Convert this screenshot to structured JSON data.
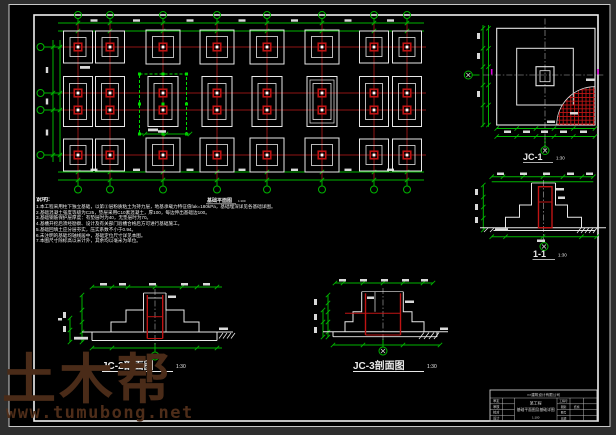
{
  "colors": {
    "window_bg": "#2e2e2e",
    "sheet": "#000000",
    "frame": "#d8d8d8",
    "green": "#00b400",
    "sel_green": "#00dd00",
    "axis_red": "#8f1414",
    "red": "#c01414",
    "white": "#e8e8e8",
    "magenta": "#dd00dd",
    "watermark": "#4a2b18"
  },
  "plan": {
    "title": "基础平面图",
    "scale": "1:100",
    "column_axes": [
      78,
      110,
      163,
      217,
      267,
      322,
      374,
      407
    ],
    "row_axes": [
      47,
      93,
      110,
      155
    ],
    "pair_columns": [
      0,
      1,
      6,
      7
    ],
    "selected_column_index": 2,
    "double_outline_column_index": 5
  },
  "notes": {
    "heading": "说明:",
    "lines": [
      "1.本工程采用柱下独立基础，以第②层粉质粘土为持力层，地基承载力特征值fak=180kPa，基础埋深详见各基础详图。",
      "2.基础混凝土强度等级为C25，垫层采用C10素混凝土，厚100，每边伸出基础边100。",
      "3.基础钢筋保护层厚度：有垫层时为40，无垫层时为70。",
      "4.基槽开挖后须经勘察、设计及有关部门验槽合格后方可进行基础施工。",
      "5.基础回填土应分层夯实，压实系数不小于0.94。",
      "6.未注明的基础均轴线居中，基础定位尺寸详见本图。",
      "7.本图尺寸除标高以米计外，其余均以毫米为单位。"
    ]
  },
  "details": {
    "jc1": {
      "title": "JC-1",
      "scale": "1:30"
    },
    "s11": {
      "title": "1-1",
      "scale": "1:30"
    },
    "jc2": {
      "title": "JC-2剖面图",
      "scale": "1:30"
    },
    "jc3": {
      "title": "JC-3剖面图",
      "scale": "1:30"
    }
  },
  "title_block": {
    "company": "××建筑设计有限公司",
    "left_fields": [
      "审定",
      "审核",
      "校对",
      "设计"
    ],
    "project": "某工程",
    "drawing_name": "基础平面图及基础详图",
    "extra": "1:100",
    "right_fields": [
      {
        "label": "工程号",
        "value": ""
      },
      {
        "label": "图别",
        "value": "结施"
      },
      {
        "label": "图号",
        "value": ""
      },
      {
        "label": "日期",
        "value": ""
      }
    ]
  },
  "watermark": {
    "logo": "土木帮",
    "url": "www.tumubong.net"
  }
}
